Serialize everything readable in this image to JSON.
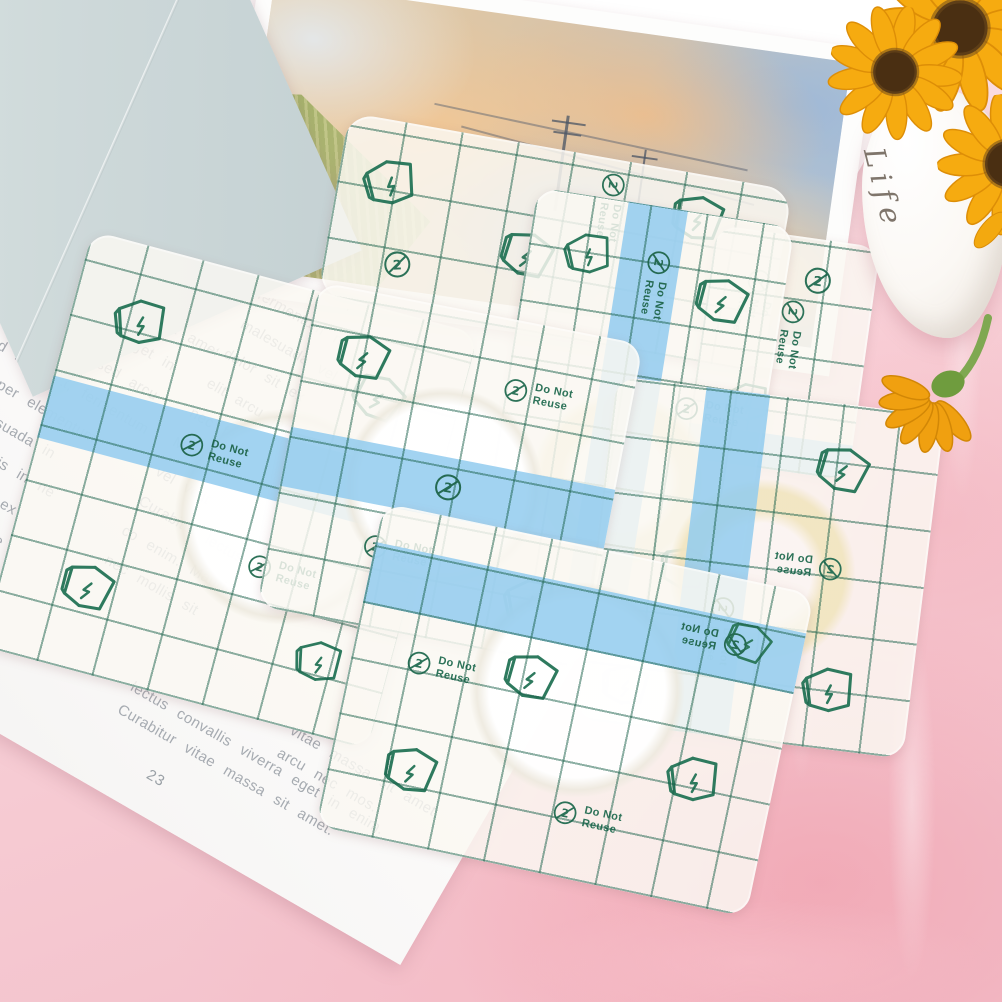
{
  "scene": {
    "background_pink": "#f6cbd3",
    "card_blue": "#cdd8d9",
    "strip_blue": "#92cbef",
    "print_green": "#2c7258",
    "sunflower_yellow": "#f6a912"
  },
  "magazine": {
    "page_number": "23",
    "column1": [
      "Curabitur vitae massa sit amet",
      "is convallis viverra eget in",
      "Mauris accumsan sed arcu",
      "is. Sed leo erat, fermentum",
      "uis, semper elementum",
      "m et malesuada in",
      "e ipsum primis in ne",
      "ipsum dolor sit ex",
      "adipiscing elit fame",
      "sed arcu nec fauci",
      "fermentum amet,",
      "fermentum Mauris"
    ],
    "column2": [
      "amet a in",
      "arcu vel in",
      "fermentum ne",
      "malesuada vel",
      "dolor sit ex",
      "elit arcu fame",
      "nec fauci amet,",
      "Mauris mollis",
      "vel velit",
      "Curabitur lectus",
      "co enim. Mauris",
      "nec mollis sit"
    ],
    "caption": [
      "lectus convallis viverra eget in enim.",
      "Curabitur vitae massa sit amet."
    ],
    "fragments": [
      "vitae massa sit amet.",
      "arcu nec mos."
    ]
  },
  "patch_print": {
    "do_not": "Do Not",
    "reuse": "Reuse"
  },
  "vase": {
    "script_text": "Life"
  }
}
